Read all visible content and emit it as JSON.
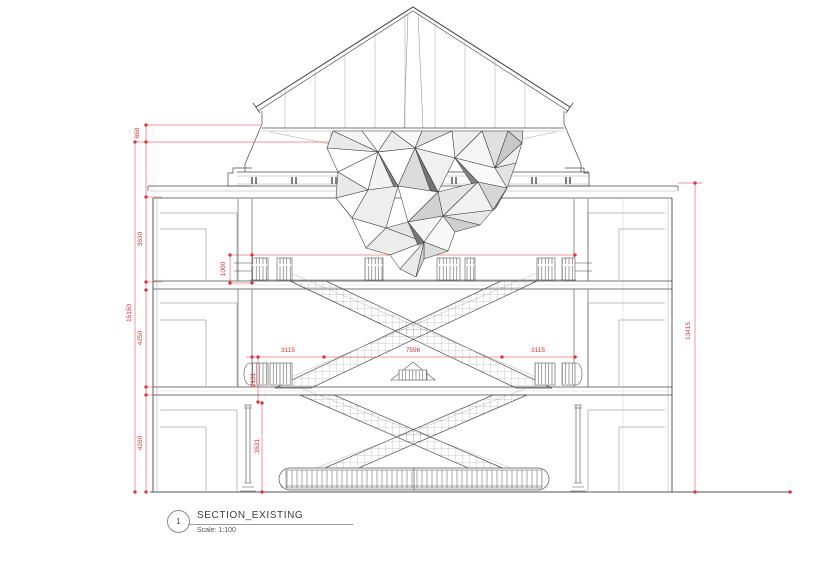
{
  "title_block": {
    "number": "1",
    "title": "SECTION_EXISTING",
    "scale": "Scale: 1:100"
  },
  "dimensions": {
    "eave_height": "650",
    "attic_storey": "3630",
    "overall_left": "15150",
    "second_storey": "4250",
    "first_storey": "4260",
    "balustrade_height": "1000",
    "landing_height": "2131",
    "ground_clear": "3531",
    "bay_left": "3115",
    "atrium_span": "7596",
    "bay_right": "3115",
    "overall_right": "13415"
  },
  "colors": {
    "dimension_red": "#d9363a",
    "line_gray": "#4a4a4a"
  }
}
